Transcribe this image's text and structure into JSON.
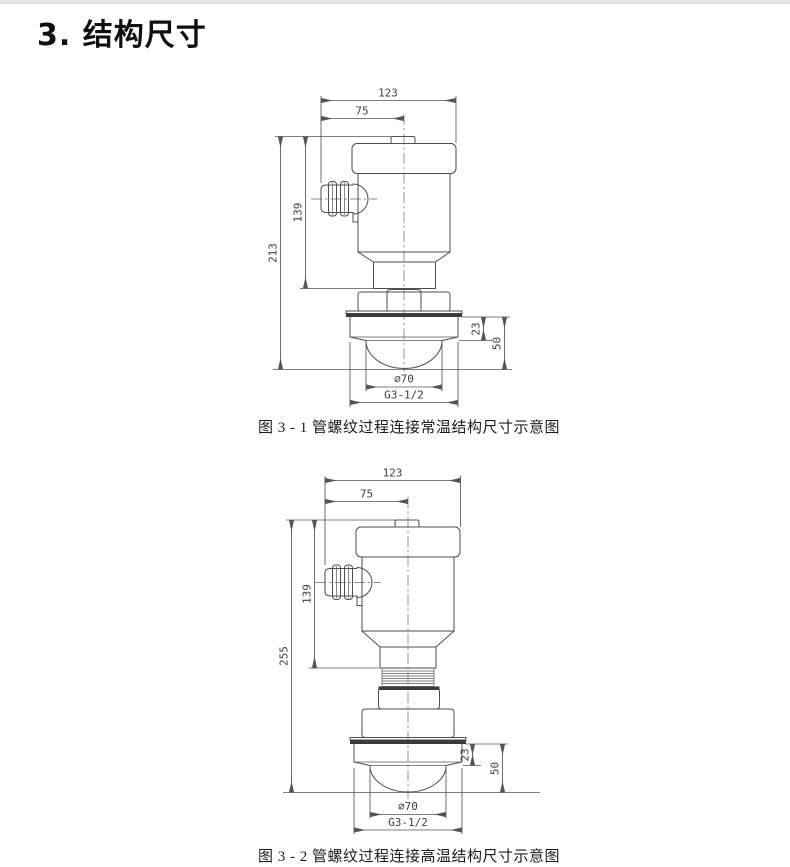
{
  "page": {
    "title": "3. 结构尺寸"
  },
  "figure1": {
    "caption": "图 3 - 1 管螺纹过程连接常温结构尺寸示意图",
    "dims": {
      "total_width": "123",
      "body_width": "75",
      "total_height": "213",
      "upper_height": "139",
      "flange_height": "23",
      "antenna_height": "50",
      "lens_diameter": "∅70",
      "thread_size": "G3-1/2"
    }
  },
  "figure2": {
    "caption": "图 3 - 2 管螺纹过程连接高温结构尺寸示意图",
    "dims": {
      "total_width": "123",
      "body_width": "75",
      "total_height": "255",
      "upper_height": "139",
      "flange_height": "23",
      "antenna_height": "50",
      "lens_diameter": "∅70",
      "thread_size": "G3-1/2"
    }
  }
}
